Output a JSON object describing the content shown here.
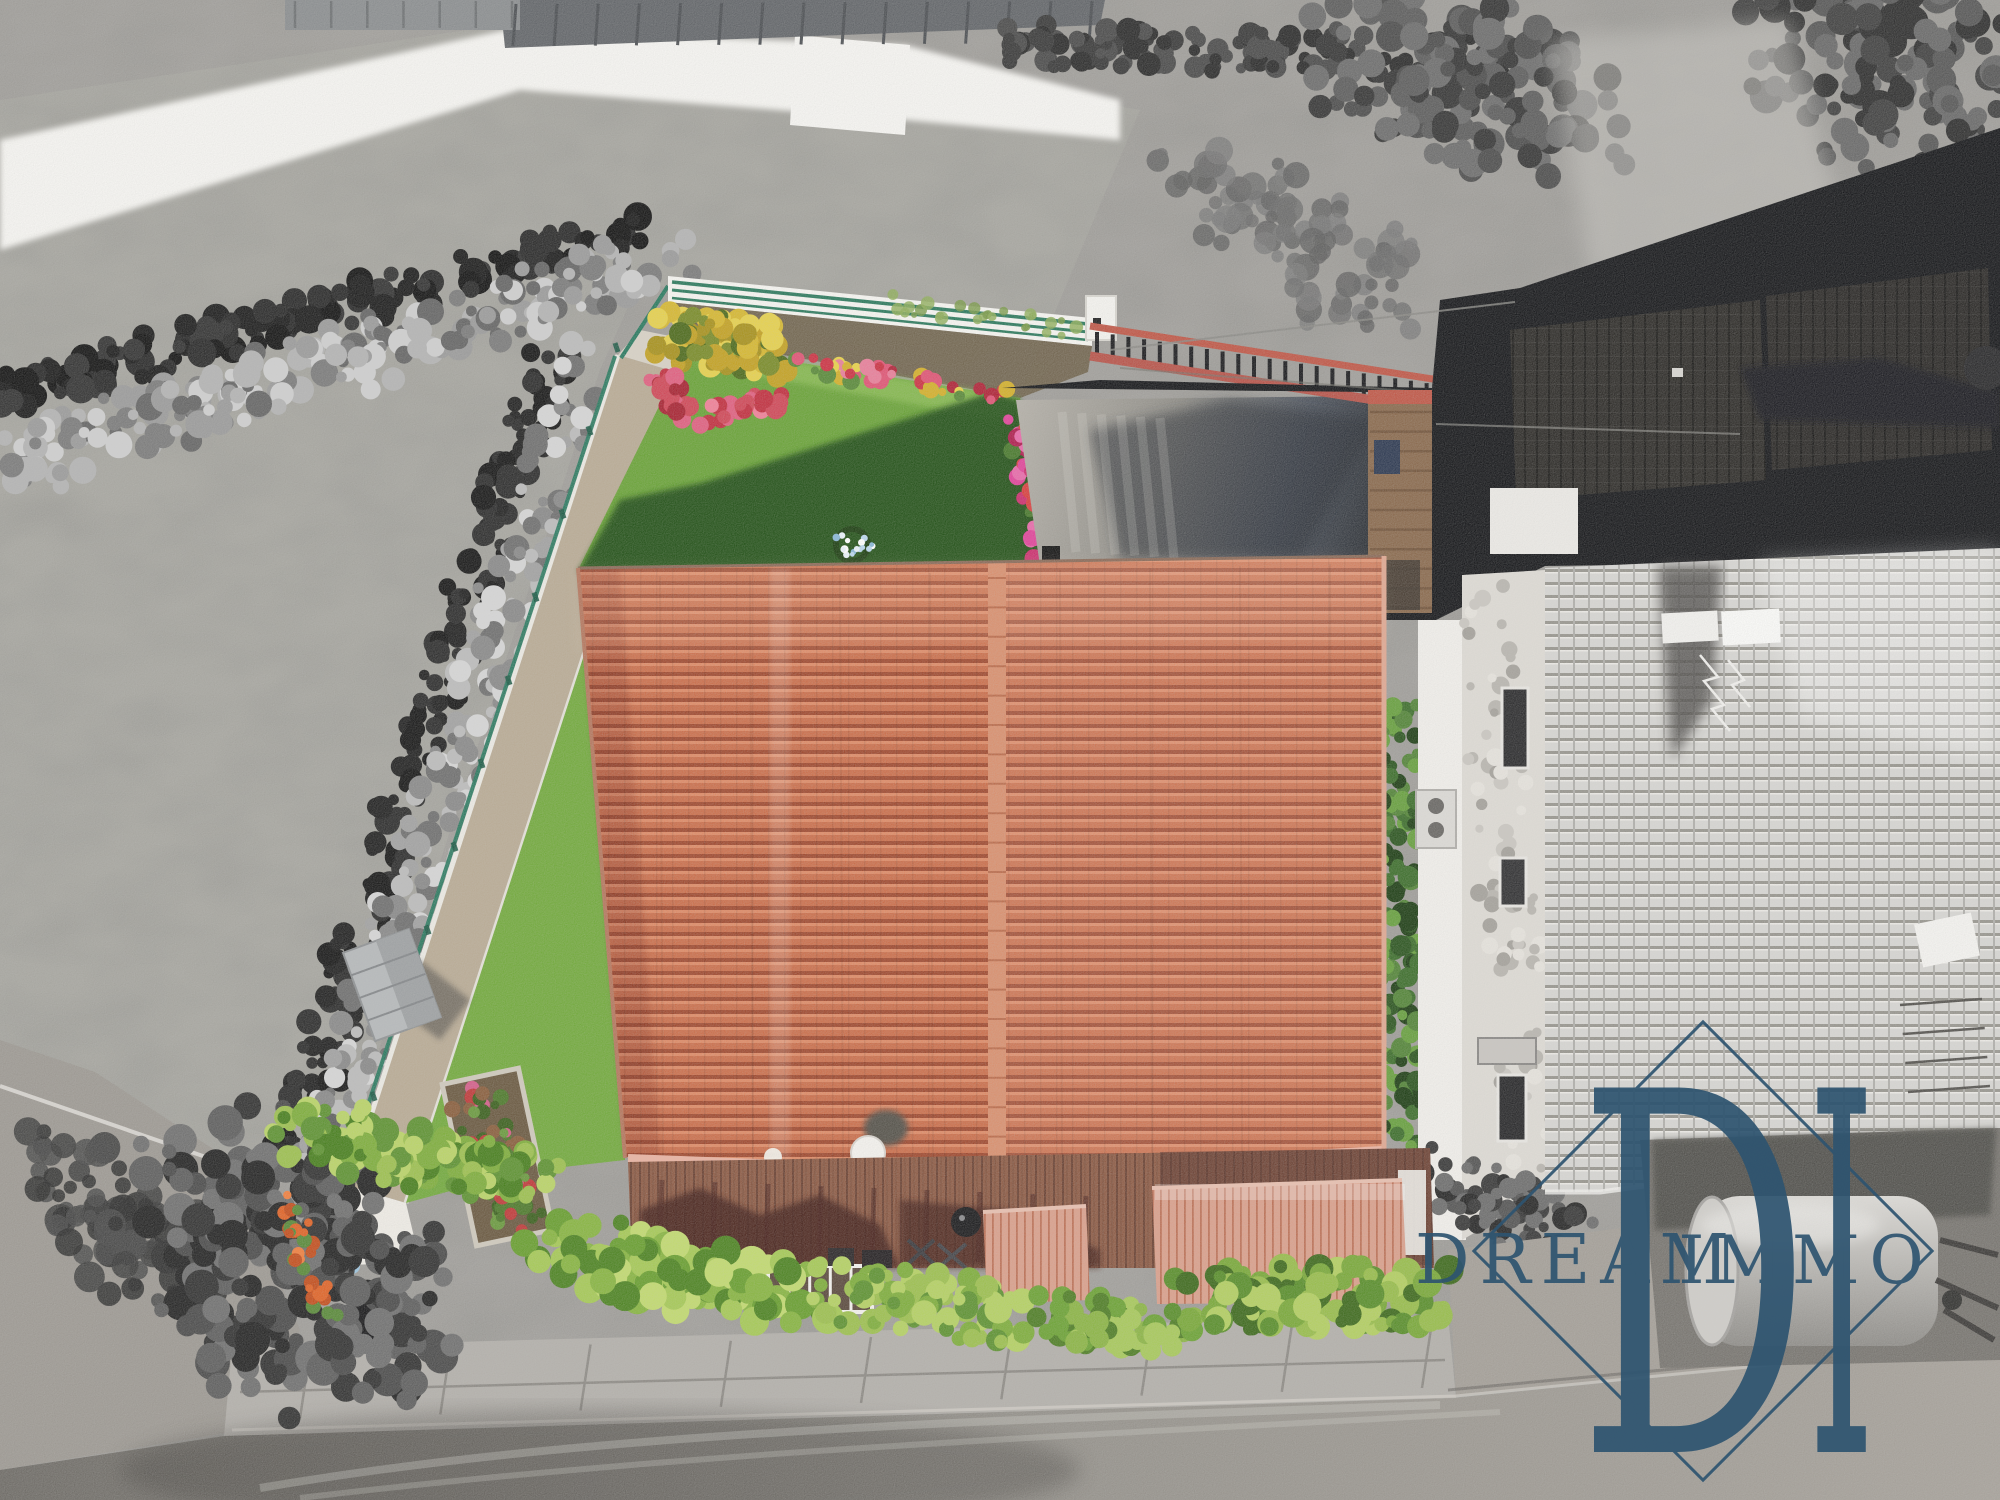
{
  "meta": {
    "title": "Aerial drone photograph of a detached house with garden",
    "style": "selective color: property in color, surroundings desaturated to black-and-white"
  },
  "watermark": {
    "brand": "DREAM IMMO",
    "word1": "DREAM",
    "word2": "IMMO",
    "monogram_d": "D",
    "monogram_i": "I",
    "color": "#2e5470"
  },
  "scene": {
    "elements": [
      {
        "name": "main-house-roof",
        "desc": "terracotta tiled gable roof, ridge vertical, two planes"
      },
      {
        "name": "chimney",
        "desc": "white round cap with cast shadow on lower roof edge"
      },
      {
        "name": "lawn",
        "desc": "green lawn partly covered by house shadow, small white flower ring"
      },
      {
        "name": "flower-beds",
        "desc": "yellow shrub cluster and red/pink flower lines along fence and courtyard"
      },
      {
        "name": "gravel-path",
        "desc": "light gravel path with white curbs along green wire fence"
      },
      {
        "name": "garden-fence",
        "desc": "teal-green wire fence around plot"
      },
      {
        "name": "gray-hedges",
        "desc": "desaturated hedge rows along field boundary"
      },
      {
        "name": "courtyard",
        "desc": "concrete courtyard, wet dark right half, metal railing with salmon rails"
      },
      {
        "name": "wood-deck",
        "desc": "brown plank deck along lower house edge with furniture shadows"
      },
      {
        "name": "salmon-canopies",
        "desc": "two corrugated salmon canopies over lower terrace"
      },
      {
        "name": "basement-windows",
        "desc": "white framed light wells below deck"
      },
      {
        "name": "green-bushes-row",
        "desc": "bright green bushes along front walkway"
      },
      {
        "name": "garden-shed",
        "desc": "small gray box shed near west fence"
      },
      {
        "name": "neighbor-roof",
        "desc": "gray concrete tile roof of adjacent house (desaturated)"
      },
      {
        "name": "gas-tank",
        "desc": "gray horizontal cylindrical tank bottom right"
      },
      {
        "name": "road-sidewalk",
        "desc": "gray sidewalk slabs and gravel road along bottom"
      },
      {
        "name": "field",
        "desc": "grayscale meadow upper left with mown texture"
      }
    ],
    "palette": {
      "roof_tile": "#cb6f4c",
      "roof_tile_light": "#de8a66",
      "roof_tile_dark": "#a04a30",
      "roof_ridge": "#d9906f",
      "roof_fascia": "#e9b3a2",
      "lawn": "#6aa338",
      "lawn_strip": "#73aa3e",
      "lawn_shadow": "#1e4a14",
      "bush_green": "#8fb842",
      "hedge_east_green": "#3e6f2d",
      "flower_red": "#cc3344",
      "flower_pink": "#e05575",
      "flower_magenta": "#cc2f6e",
      "flower_yellow": "#e0c23a",
      "flower_orange": "#e06428",
      "fence_green": "#2a7a60",
      "gravel_path": "#b9ab95",
      "deck_wood": "#8d5b45",
      "deck_shadow": "#45221c",
      "canopy_salmon": "#daa08c",
      "railing_salmon": "#c05848",
      "courtyard_light": "#b5b1a9",
      "courtyard_dark": "#101214",
      "white_path": "#f6f5f2",
      "field_gray": "#a7a6a0",
      "neighbor_tile": "#d7d6d3",
      "stone_band": "#dedbd5",
      "sidewalk": "#b3b0ab",
      "road_dark": "#6e6b66",
      "road_light": "#a7a29b",
      "tank_gray": "#c9c7c3",
      "metal_roof": "#63666a",
      "dark_zone": "#17181b"
    }
  }
}
